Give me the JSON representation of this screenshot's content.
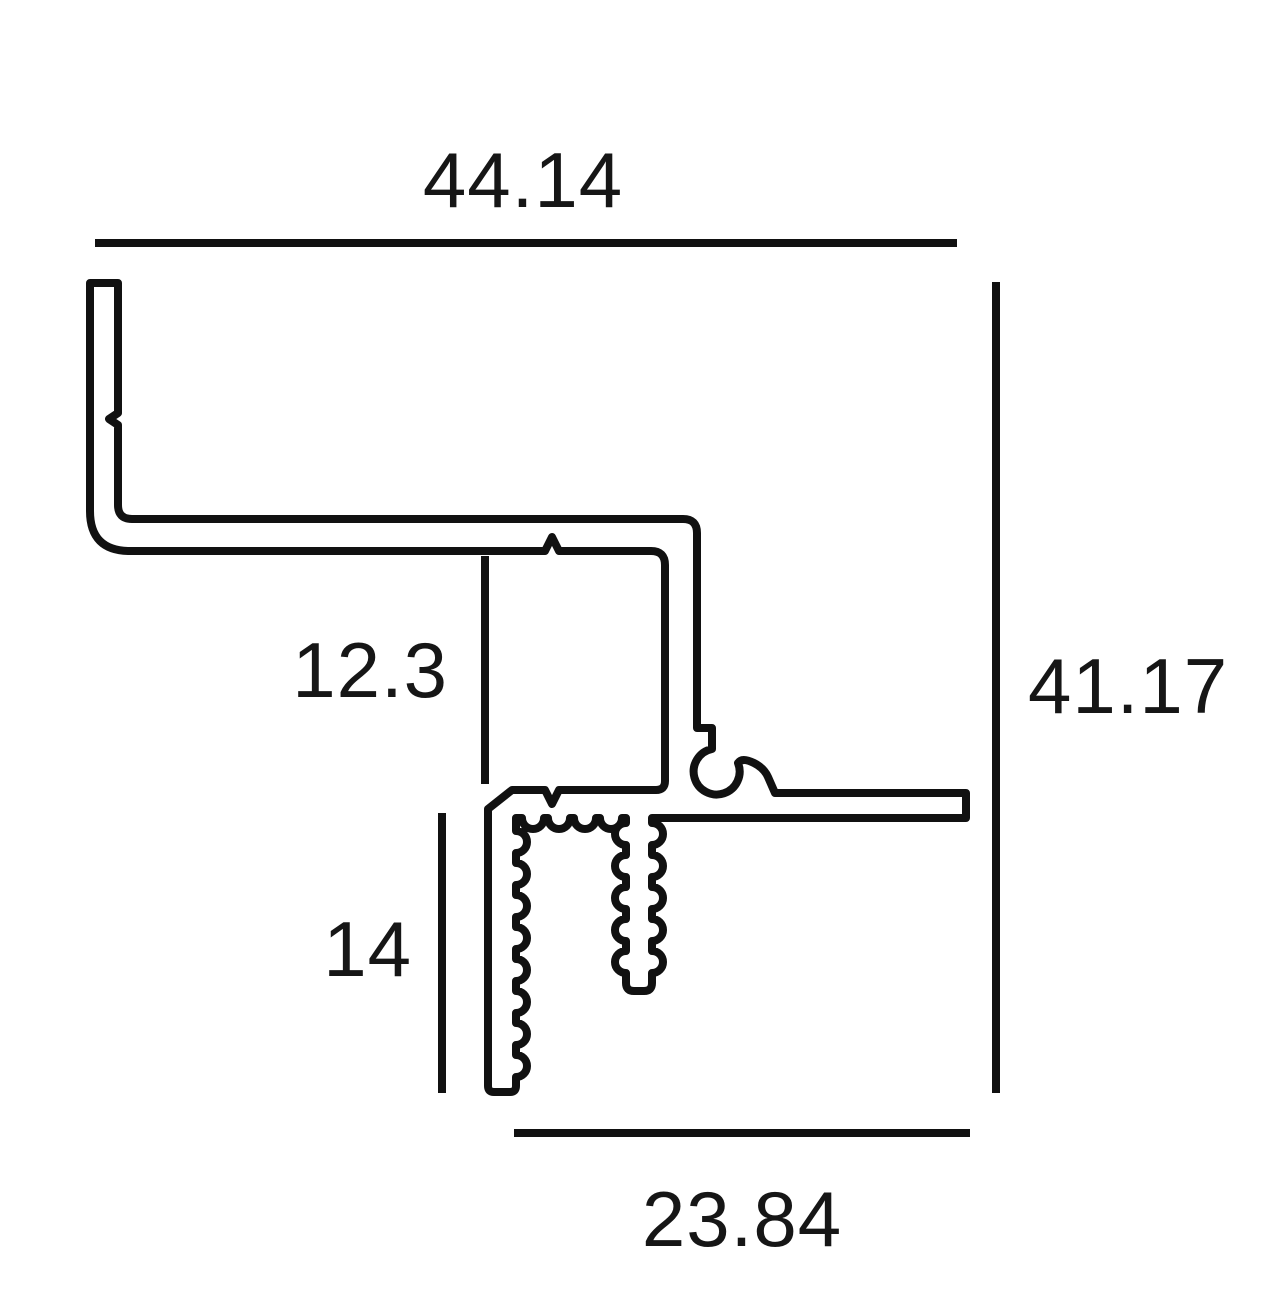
{
  "drawing": {
    "type": "profile-cross-section",
    "background_color": "#ffffff",
    "line_color": "#111111",
    "dimensions": {
      "top_width": "44.14",
      "right_height": "41.17",
      "step_height": "12.3",
      "channel_depth": "14",
      "bottom_width": "23.84"
    }
  }
}
